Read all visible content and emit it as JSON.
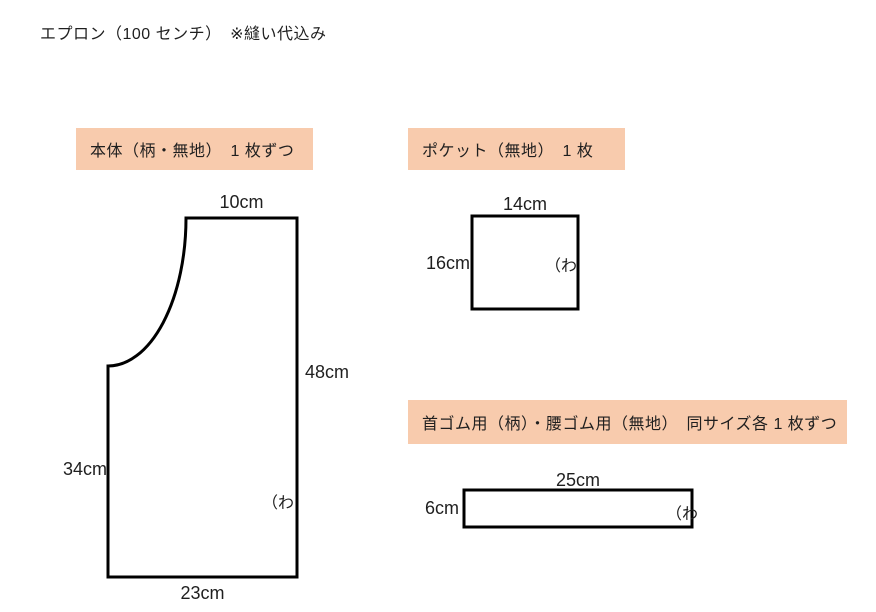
{
  "title": "エプロン（100 センチ）　※縫い代込み",
  "colors": {
    "label_background": "#F8CBAD",
    "outline": "#000000",
    "text": "#1F1F1F"
  },
  "sections": {
    "body_label": "本体（柄・無地）　1 枚ずつ",
    "pocket_label": "ポケット（無地）　1 枚",
    "straps_label": "首ゴム用（柄）・腰ゴム用（無地）　同サイズ各 1 枚ずつ"
  },
  "pieces": {
    "body": {
      "top_width": "10cm",
      "right_height": "48cm",
      "left_height": "34cm",
      "bottom_width": "23cm",
      "fold_mark": "（わ"
    },
    "pocket": {
      "top_width": "14cm",
      "left_height": "16cm",
      "fold_mark": "（わ"
    },
    "strap": {
      "top_width": "25cm",
      "left_height": "6cm",
      "fold_mark": "（わ"
    }
  }
}
